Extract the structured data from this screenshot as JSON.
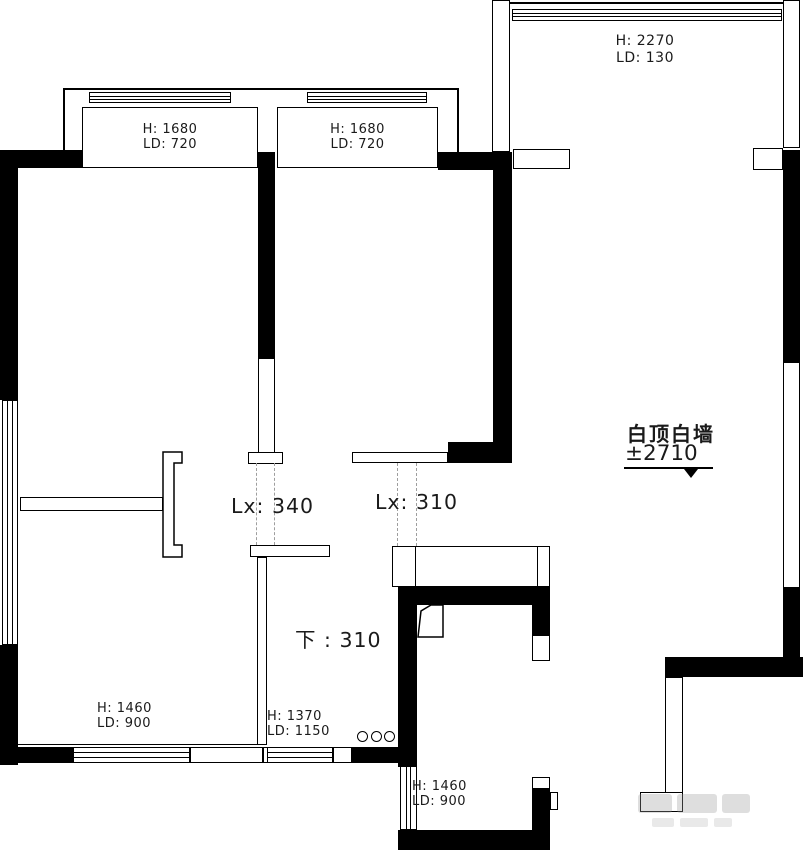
{
  "colors": {
    "wall": "#000000",
    "outline": "#000000",
    "dashed_beam_line": "#9e9e9e",
    "text": "#1a1a1a",
    "watermark_gray": "#bdbdbd"
  },
  "windows": {
    "bay_left": {
      "h": "H: 1680",
      "ld": "LD: 720"
    },
    "bay_mid": {
      "h": "H: 1680",
      "ld": "LD: 720"
    },
    "top_right": {
      "h": "H: 2270",
      "ld": "LD: 130"
    },
    "bottom_left": {
      "h": "H: 1460",
      "ld": "LD: 900"
    },
    "bottom_mid": {
      "h": "H: 1370",
      "ld": "LD: 1150"
    },
    "bath": {
      "h": "H: 1460",
      "ld": "LD: 900"
    }
  },
  "beams": {
    "hall_beam": "Lx: 340",
    "kitchen_beam": "Lx: 310",
    "step_down": "下 : 310"
  },
  "ceiling": {
    "note": "白顶白墙",
    "level": "±2710"
  }
}
